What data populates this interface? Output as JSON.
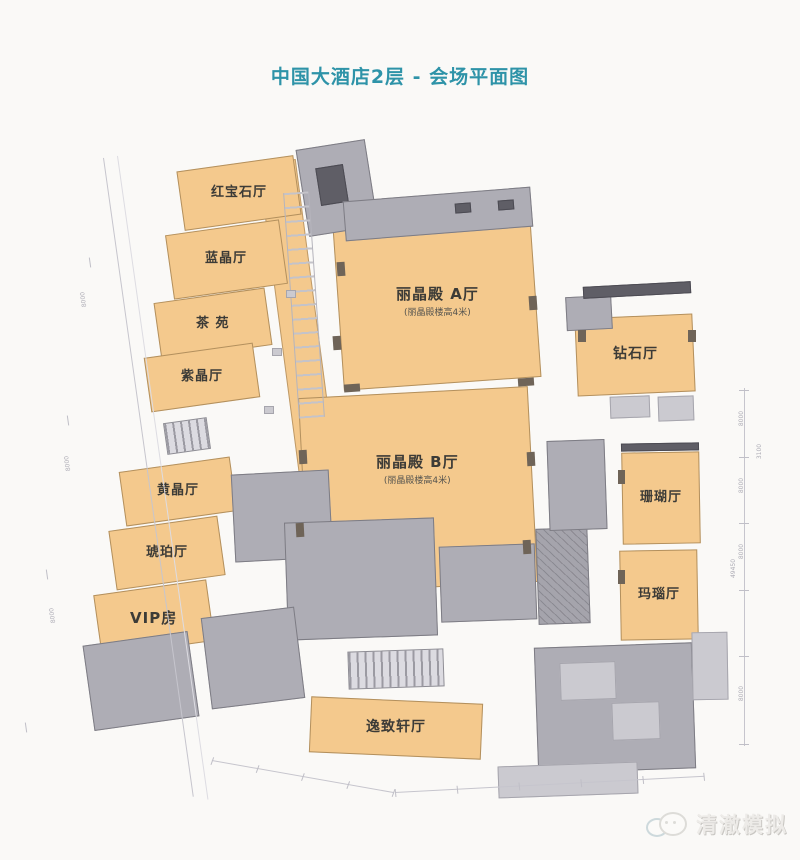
{
  "title": "中国大酒店2层 - 会场平面图",
  "colors": {
    "title_accent": "#2e93a8",
    "room_fill": "#f4c98d",
    "service_gray": "#aeadb5"
  },
  "rooms": [
    {
      "id": "ruby-hall",
      "name": "红宝石厅"
    },
    {
      "id": "blue-crystal-hall",
      "name": "蓝晶厅"
    },
    {
      "id": "tea-garden",
      "name": "茶 苑"
    },
    {
      "id": "amethyst-hall",
      "name": "紫晶厅"
    },
    {
      "id": "citrine-hall",
      "name": "黄晶厅"
    },
    {
      "id": "amber-hall",
      "name": "琥珀厅"
    },
    {
      "id": "vip-room",
      "name": "VIP房"
    },
    {
      "id": "regent-hall-a",
      "name": "丽晶殿 A厅",
      "note": "(丽晶殿楼高4米)"
    },
    {
      "id": "regent-hall-b",
      "name": "丽晶殿 B厅",
      "note": "(丽晶殿楼高4米)"
    },
    {
      "id": "diamond-hall",
      "name": "钻石厅"
    },
    {
      "id": "coral-hall",
      "name": "珊瑚厅"
    },
    {
      "id": "agate-hall",
      "name": "玛瑙厅"
    },
    {
      "id": "yizhixuan-hall",
      "name": "逸致轩厅"
    }
  ],
  "dimensions": {
    "segment": "8000",
    "offset": "3100",
    "total": "49450"
  },
  "watermark": {
    "text": "清澈模拟",
    "icon": "chat-bubbles-icon"
  }
}
